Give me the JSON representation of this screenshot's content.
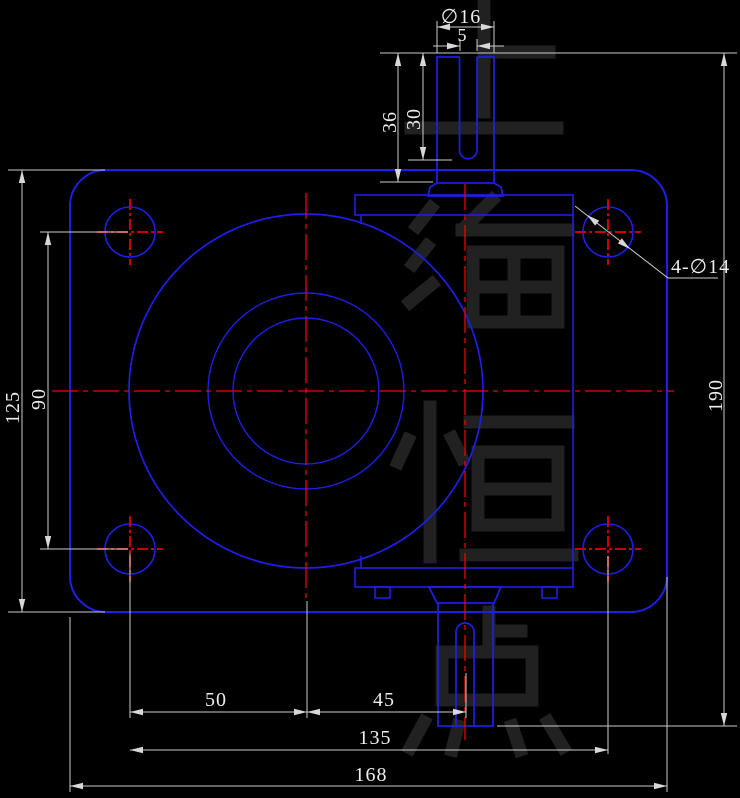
{
  "drawing": {
    "title": "Worm gearbox housing - front view CAD drawing",
    "background": "#000000",
    "colors": {
      "outline": "#1e1ee8",
      "centerline": "#f00000",
      "hole_centerline": "#c80000",
      "dimension_line": "#cdcdcd",
      "dimension_text": "#eeeeee",
      "watermark": "#212121"
    },
    "dims": {
      "shaft_diameter": "∅16",
      "keyway_width": "5",
      "shaft_length": "36",
      "keyway_depth": "30",
      "bolt_holes": "4-∅14",
      "plate_height": "125",
      "bolt_pitch_vertical": "90",
      "overall_height": "190",
      "center_to_left_bolt": "50",
      "center_to_output_shaft": "45",
      "bolt_pitch_horizontal": "135",
      "plate_width": "168"
    },
    "watermark": {
      "text": "上海恒点"
    }
  }
}
